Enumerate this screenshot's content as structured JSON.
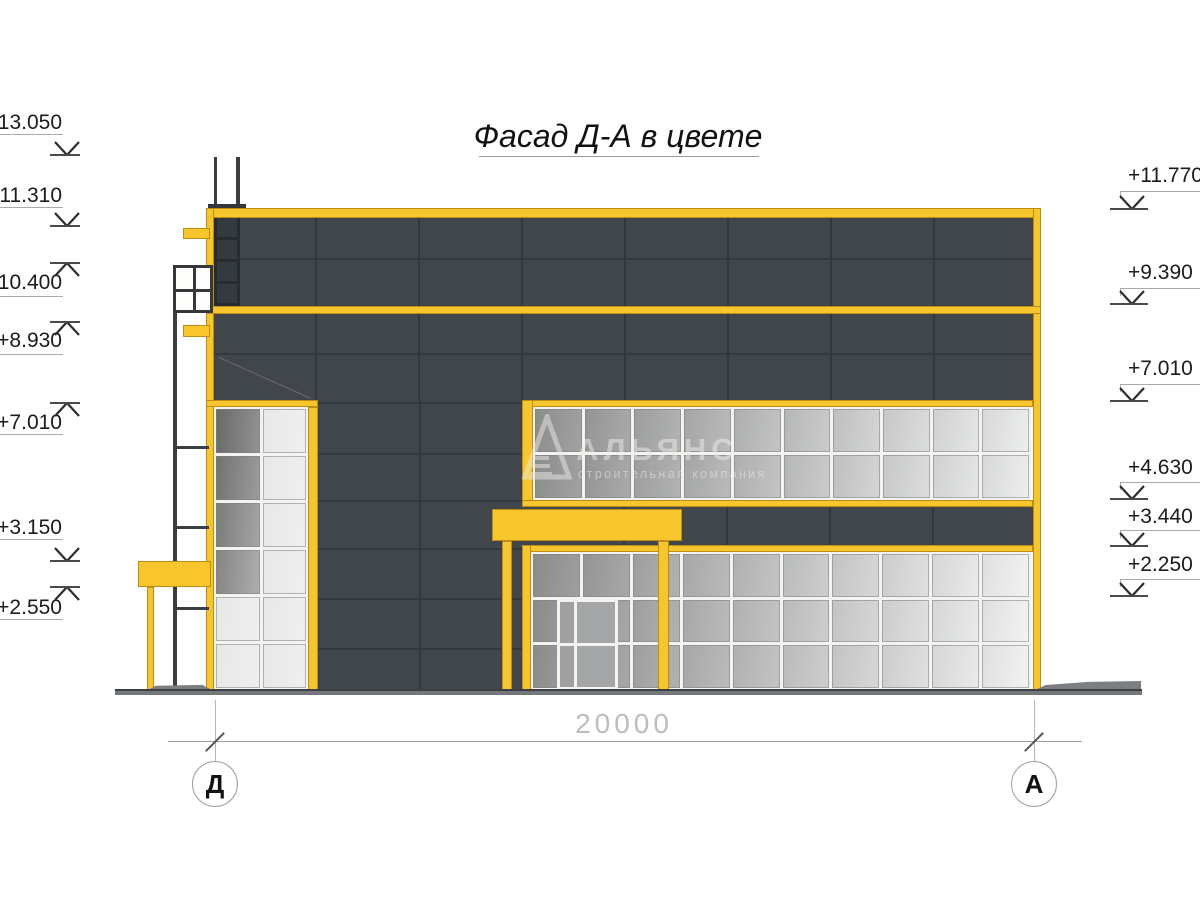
{
  "title": "Фасад Д-А в цвете",
  "watermark": {
    "name": "АЛЬЯНС",
    "subtitle": "строительная компания"
  },
  "dimension": {
    "value": "20000"
  },
  "axes": [
    {
      "label": "Д"
    },
    {
      "label": "А"
    }
  ],
  "colors": {
    "accent_yellow": "#F6C62C",
    "yellow_outline": "#BD8C15",
    "wall_dark": "#41464B",
    "wall_seam": "#33383D",
    "mullion_white": "#F3F3F1",
    "steel_dark": "#3A3E42",
    "ground_gray": "#75787A",
    "ground_edge": "#3C4043"
  },
  "elevation_marks": {
    "left": [
      {
        "label": "+13.050",
        "text_y": 123,
        "shelf_y": 134,
        "tip_y": 155,
        "dir": "down"
      },
      {
        "label": "+11.310",
        "text_y": 196,
        "shelf_y": 207,
        "tip_y": 226,
        "dir": "down"
      },
      {
        "label": "+10.400",
        "text_y": 283,
        "shelf_y": 296,
        "tip_y": 263,
        "dir": "up"
      },
      {
        "label": "+8.930",
        "text_y": 341,
        "shelf_y": 354,
        "tip_y": 322,
        "dir": "up"
      },
      {
        "label": "+7.010",
        "text_y": 423,
        "shelf_y": 434,
        "tip_y": 403,
        "dir": "up"
      },
      {
        "label": "+3.150",
        "text_y": 528,
        "shelf_y": 539,
        "tip_y": 561,
        "dir": "down"
      },
      {
        "label": "+2.550",
        "text_y": 608,
        "shelf_y": 619,
        "tip_y": 587,
        "dir": "up"
      }
    ],
    "right": [
      {
        "label": "+11.770",
        "text_y": 176,
        "shelf_y": 191,
        "tip_y": 209,
        "dir": "down"
      },
      {
        "label": "+9.390",
        "text_y": 273,
        "shelf_y": 288,
        "tip_y": 304,
        "dir": "down"
      },
      {
        "label": "+7.010",
        "text_y": 369,
        "shelf_y": 384,
        "tip_y": 401,
        "dir": "down"
      },
      {
        "label": "+4.630",
        "text_y": 468,
        "shelf_y": 482,
        "tip_y": 499,
        "dir": "down"
      },
      {
        "label": "+3.440",
        "text_y": 517,
        "shelf_y": 530,
        "tip_y": 546,
        "dir": "down"
      },
      {
        "label": "+2.250",
        "text_y": 565,
        "shelf_y": 579,
        "tip_y": 596,
        "dir": "down"
      }
    ]
  },
  "facade": {
    "window_grids": {
      "tower": {
        "cols": 2,
        "rows": 6
      },
      "middle": {
        "cols": 10,
        "rows": 2
      },
      "lower": {
        "cols": 10,
        "rows": 3
      }
    }
  }
}
